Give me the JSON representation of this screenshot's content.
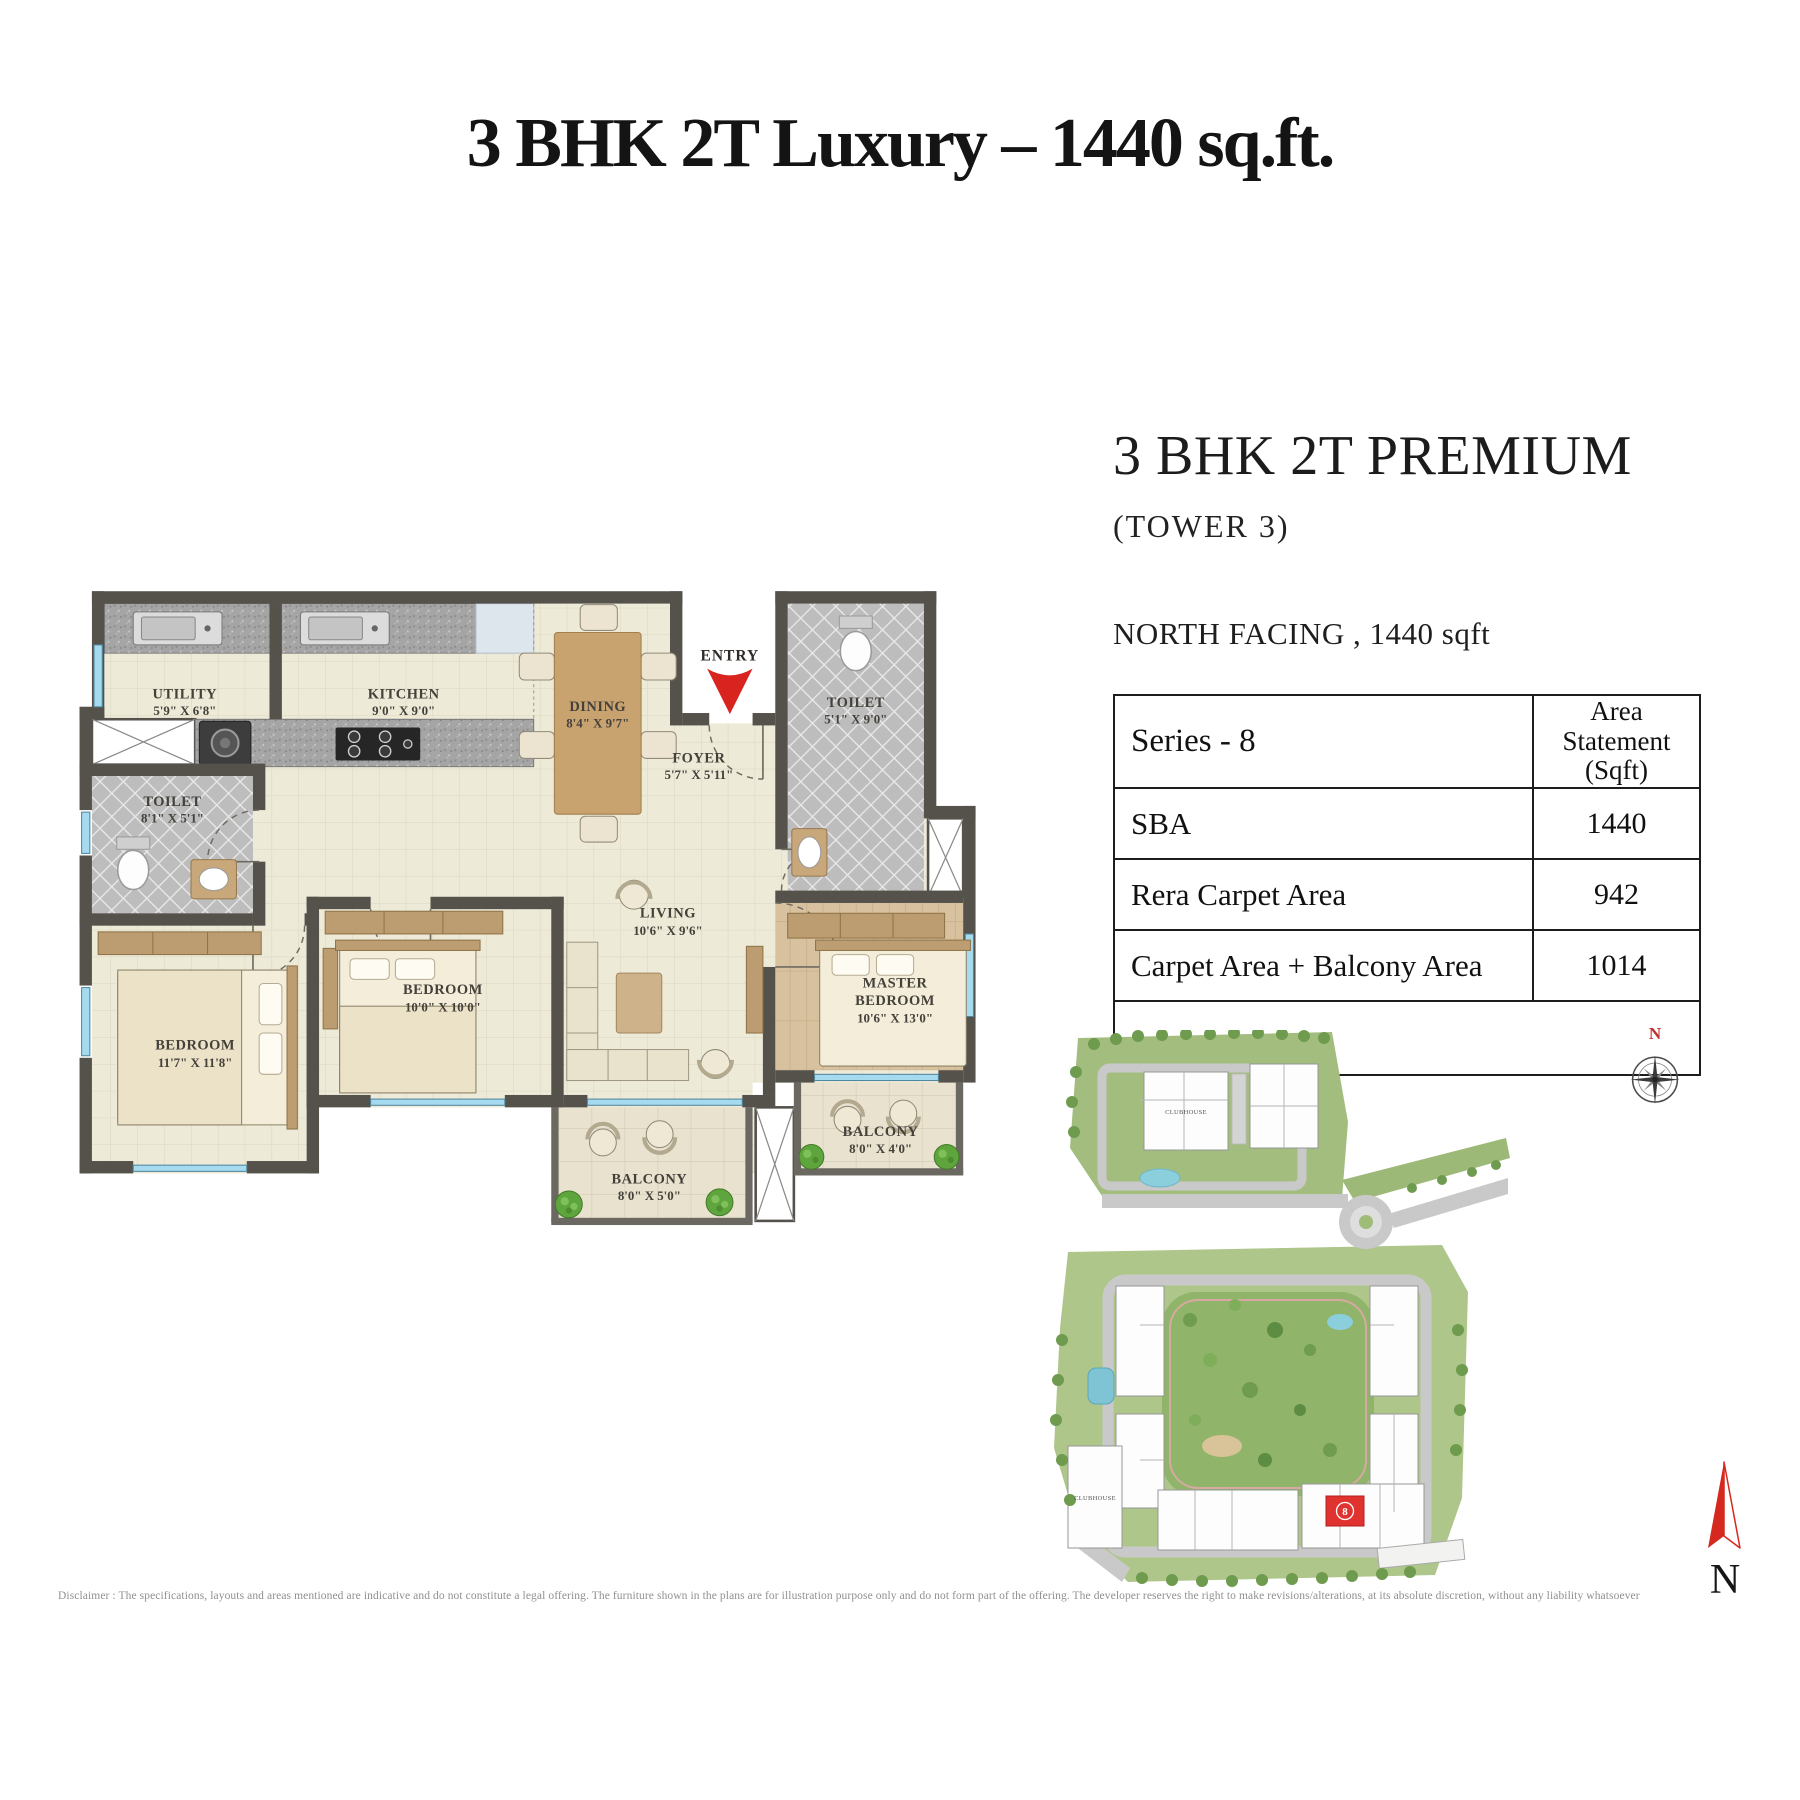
{
  "title": "3 BHK 2T Luxury – 1440 sq.ft.",
  "unit": {
    "heading": "3 BHK 2T PREMIUM",
    "tower": "(TOWER 3)",
    "facing": "NORTH FACING , 1440 sqft"
  },
  "area_table": {
    "series_label": "Series - 8",
    "col_header_line1": "Area Statement",
    "col_header_line2": "(Sqft)",
    "rows": [
      {
        "label": "SBA",
        "value": "1440"
      },
      {
        "label": "Rera Carpet Area",
        "value": "942"
      },
      {
        "label": "Carpet Area + Balcony Area",
        "value": "1014"
      }
    ]
  },
  "floor_plan": {
    "entry_label": "ENTRY",
    "rooms": {
      "utility": {
        "name": "UTILITY",
        "dims": "5'9\" X 6'8\""
      },
      "kitchen": {
        "name": "KITCHEN",
        "dims": "9'0\" X 9'0\""
      },
      "dining": {
        "name": "DINING",
        "dims": "8'4\" X 9'7\""
      },
      "toilet_top": {
        "name": "TOILET",
        "dims": "5'1\" X 9'0\""
      },
      "foyer": {
        "name": "FOYER",
        "dims": "5'7\" X 5'11\""
      },
      "toilet_left": {
        "name": "TOILET",
        "dims": "8'1\" X 5'1\""
      },
      "bedroom_left": {
        "name": "BEDROOM",
        "dims": "11'7\" X 11'8\""
      },
      "bedroom_mid": {
        "name": "BEDROOM",
        "dims": "10'0\" X 10'0\""
      },
      "living": {
        "name": "LIVING",
        "dims": "10'6\" X 9'6\""
      },
      "master": {
        "name1": "MASTER",
        "name2": "BEDROOM",
        "dims": "10'6\" X 13'0\""
      },
      "balcony_living": {
        "name": "BALCONY",
        "dims": "8'0\" X 5'0\""
      },
      "balcony_master": {
        "name": "BALCONY",
        "dims": "8'0\" X 4'0\""
      }
    }
  },
  "site_plan": {
    "clubhouse_top": "CLUBHOUSE",
    "clubhouse_bottom": "CLUBHOUSE",
    "highlighted_unit": "8",
    "compass_label": "N"
  },
  "north_indicator": {
    "label": "N"
  },
  "disclaimer": "Disclaimer : The specifications, layouts and areas mentioned are indicative and do not constitute a legal offering. The furniture shown in the plans are for illustration purpose only and do not form part of the offering. The developer reserves the right to make revisions/alterations, at its absolute discretion, without any liability whatsoever",
  "colors": {
    "accent_red": "#d8231f",
    "wall": "#55524c",
    "wood_floor": "#d8c19e",
    "cream_floor": "#edead8",
    "site_green": "#a9c386",
    "road_gray": "#c7c7c7"
  }
}
